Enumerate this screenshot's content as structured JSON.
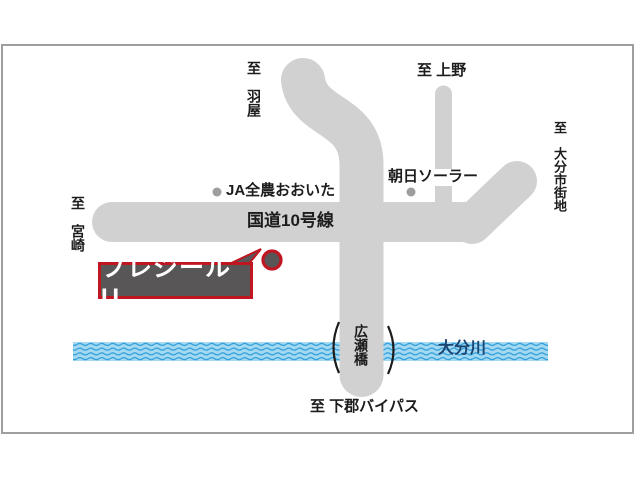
{
  "map": {
    "callout": {
      "name": "プレジールU"
    },
    "roads": {
      "route10_label": "国道10号線",
      "to_haneya": "至　羽屋",
      "to_ueno": "至 上野",
      "to_oita_city": "至　大分市街地",
      "to_miyazaki": "至　宮崎",
      "to_shimogori_bypass": "至 下郡バイパス"
    },
    "river": {
      "name": "大分川"
    },
    "bridge": {
      "name": "広瀬橋"
    },
    "pois": {
      "ja_zennoh": "JA全農おおいた",
      "asahi_solar": "朝日ソーラー"
    },
    "colors": {
      "road": "#d1d1d1",
      "frame": "#9e9e9e",
      "text": "#1c1c1c",
      "river_base": "#a5d9f2",
      "river_wave": "#2f9fda",
      "river_text": "#1a4472",
      "poi_dot": "#9e9e9e",
      "callout_bg": "#585656",
      "callout_border": "#c01622",
      "bridge_mark": "#1c1c1c"
    }
  }
}
